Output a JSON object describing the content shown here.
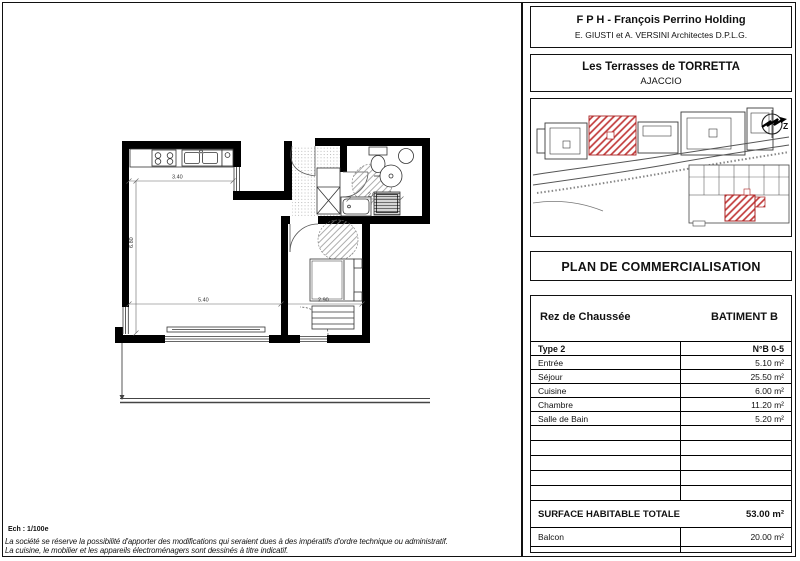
{
  "header": {
    "company": "F P H - François Perrino Holding",
    "architects": "E. GIUSTI et A. VERSINI Architectes D.P.L.G."
  },
  "project": {
    "name": "Les Terrasses de TORRETTA",
    "city": "AJACCIO"
  },
  "site_plan": {
    "compass_label": "Z"
  },
  "doc_title": "PLAN DE COMMERCIALISATION",
  "table": {
    "floor": "Rez de Chaussée",
    "building": "BATIMENT B",
    "type": "Type 2",
    "unit": "N°B 0-5",
    "rooms": [
      {
        "label": "Entrée",
        "area": "5.10 m²"
      },
      {
        "label": "Séjour",
        "area": "25.50 m²"
      },
      {
        "label": "Cuisine",
        "area": "6.00 m²"
      },
      {
        "label": "Chambre",
        "area": "11.20 m²"
      },
      {
        "label": "Salle de Bain",
        "area": "5.20 m²"
      }
    ],
    "total_label": "SURFACE HABITABLE TOTALE",
    "total_area": "53.00 m²",
    "balcony_label": "Balcon",
    "balcony_area": "20.00 m²"
  },
  "plan_dims": {
    "kitchen_width": "3.40",
    "room_depth": "6.80",
    "living_width": "5.40",
    "bedroom_width": "2.90",
    "bath_width": "2.01"
  },
  "footer": {
    "scale": "Ech : 1/100e",
    "disclaimer1": "La société se réserve la possibilité d'apporter des modifications qui seraient dues à des impératifs d'ordre technique ou administratif.",
    "disclaimer2": "La cuisine, le mobilier et les appareils électroménagers sont dessinés à titre indicatif."
  },
  "colors": {
    "highlight": "#c23b3b",
    "wall": "#000000"
  }
}
